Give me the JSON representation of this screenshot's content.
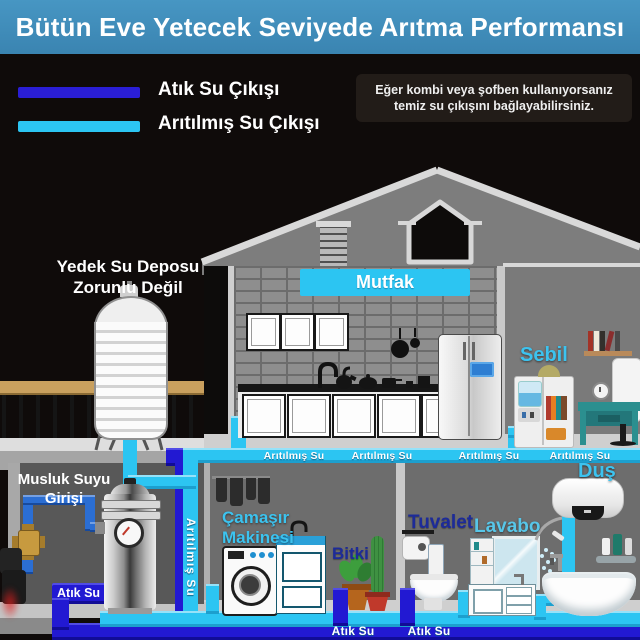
{
  "banner": {
    "title": "Bütün Eve Yetecek Seviyede Arıtma Performansı",
    "bg_color": "#3e8cba"
  },
  "legend": {
    "items": [
      {
        "label": "Atık Su Çıkışı",
        "color": "#2a1ed6"
      },
      {
        "label": "Arıtılmış Su Çıkışı",
        "color": "#2cc5f2"
      }
    ],
    "note": "Eğer kombi veya şofben kullanıyorsanız temiz su çıkışını bağlayabilirsiniz."
  },
  "annotations": {
    "backup_tank": [
      "Yedek Su Deposu",
      "Zorunlu Değil"
    ],
    "tap_inlet": [
      "Musluk Suyu",
      "Girişi"
    ],
    "washing_machine": [
      "Çamaşır",
      "Makinesi"
    ]
  },
  "rooms": {
    "kitchen": "Mutfak",
    "dispenser": "Sebil",
    "plant": "Bitki",
    "toilet": "Tuvalet",
    "sink": "Lavabo",
    "shower": "Duş"
  },
  "pipes": {
    "purified_labels": [
      "Arıtılmış Su",
      "Arıtılmış Su",
      "Arıtılmış Su",
      "Arıtılmış Su"
    ],
    "purified_vertical_label": "Arıtılmış Su",
    "waste_label_left": "Atık Su",
    "waste_labels_bottom": [
      "Atık Su",
      "Atık Su"
    ],
    "colors": {
      "purified": "#2cc5f2",
      "waste": "#2219d2",
      "tap_water": "#2b6ed3"
    }
  }
}
